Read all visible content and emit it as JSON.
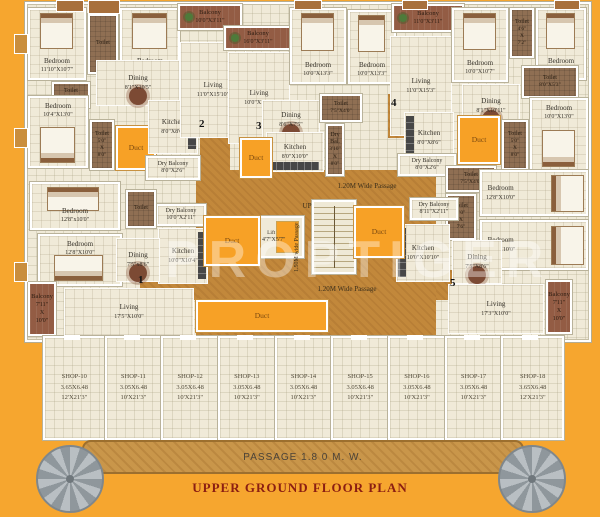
{
  "footer": {
    "passage": "PASSAGE 1.8 0 M. W.",
    "title": "UPPER GROUND FLOOR PLAN",
    "watermark": "PROPTIGER"
  },
  "colors": {
    "background_orange": "#F6A62F",
    "room_cream": "#F0EAD8",
    "passage_tan": "#C2883B",
    "duct_orange": "#F7A126",
    "toilet_brown": "#8F6F53",
    "balcony_brown": "#935C44",
    "wall_white": "#FFFFFF",
    "title_maroon": "#8B1E12"
  },
  "rooms": [
    {
      "id": "bedroom-nw-1",
      "label": "Bedroom",
      "dims": "11'10\"X10'7\"",
      "type": "room",
      "furn": "bed-t",
      "x": 28,
      "y": 8,
      "w": 58,
      "h": 72
    },
    {
      "id": "toilet-nw-1",
      "label": "Toilet",
      "dims": "",
      "type": "toilet",
      "furn": "",
      "x": 88,
      "y": 14,
      "w": 30,
      "h": 60
    },
    {
      "id": "bedroom-nw-2",
      "label": "Bedroom",
      "dims": "10'0\"X10'7\"",
      "type": "room",
      "furn": "bed-t",
      "x": 120,
      "y": 8,
      "w": 60,
      "h": 72
    },
    {
      "id": "toilet-nw-2",
      "label": "Toilet",
      "dims": "4'0\"X5'0\"",
      "type": "toilet",
      "furn": "",
      "x": 52,
      "y": 82,
      "w": 38,
      "h": 26
    },
    {
      "id": "dining-nw",
      "label": "Dining",
      "dims": "8'1\"X10'5\"",
      "type": "open",
      "furn": "table",
      "x": 96,
      "y": 60,
      "w": 84,
      "h": 46
    },
    {
      "id": "bedroom-nw-3",
      "label": "Bedroom",
      "dims": "10'4\"X13'0\"",
      "type": "room",
      "furn": "bed-b",
      "x": 28,
      "y": 96,
      "w": 60,
      "h": 72
    },
    {
      "id": "toilet-nw-3",
      "label": "Toilet",
      "dims": "5'0\"X8'0\"",
      "type": "toilet-v",
      "furn": "",
      "x": 90,
      "y": 120,
      "w": 24,
      "h": 50
    },
    {
      "id": "duct-nw",
      "label": "Duct",
      "dims": "",
      "type": "duct",
      "furn": "",
      "x": 116,
      "y": 126,
      "w": 40,
      "h": 44
    },
    {
      "id": "kitchen-nw",
      "label": "Kitchen",
      "dims": "8'0\"X8'6\"",
      "type": "open",
      "furn": "counter-r",
      "x": 148,
      "y": 100,
      "w": 50,
      "h": 54
    },
    {
      "id": "drybalcony-nw",
      "label": "Dry Balcony",
      "dims": "8'0\"X2'6\"",
      "type": "dry",
      "furn": "",
      "x": 146,
      "y": 156,
      "w": 54,
      "h": 24
    },
    {
      "id": "living-nw",
      "label": "Living",
      "dims": "11'0\"X15'10\"",
      "type": "open",
      "furn": "",
      "x": 180,
      "y": 42,
      "w": 66,
      "h": 96
    },
    {
      "id": "balcony-top-1",
      "label": "Balcony",
      "dims": "10'0\"X3'11\"",
      "type": "balcony",
      "furn": "",
      "x": 178,
      "y": 4,
      "w": 64,
      "h": 26
    },
    {
      "id": "balcony-top-2",
      "label": "Balcony",
      "dims": "16'0\"X3'11\"",
      "type": "balcony",
      "furn": "",
      "x": 224,
      "y": 26,
      "w": 68,
      "h": 24
    },
    {
      "id": "living-center",
      "label": "Living",
      "dims": "10'0\"X15'5\"",
      "type": "open",
      "furn": "",
      "x": 228,
      "y": 52,
      "w": 62,
      "h": 92
    },
    {
      "id": "bedroom-c-1",
      "label": "Bedroom",
      "dims": "10'0\"X13'3\"",
      "type": "room",
      "furn": "bed-t",
      "x": 290,
      "y": 8,
      "w": 56,
      "h": 76
    },
    {
      "id": "bedroom-c-2",
      "label": "Bedroom",
      "dims": "10'0\"X13'3\"",
      "type": "room",
      "furn": "bed-t",
      "x": 348,
      "y": 10,
      "w": 48,
      "h": 74
    },
    {
      "id": "dining-c",
      "label": "Dining",
      "dims": "8'6\"X7'5\"",
      "type": "open",
      "furn": "table",
      "x": 262,
      "y": 100,
      "w": 58,
      "h": 40
    },
    {
      "id": "toilet-c-1",
      "label": "Toilet",
      "dims": "7'5\"X4'0\"",
      "type": "toilet",
      "furn": "",
      "x": 320,
      "y": 94,
      "w": 42,
      "h": 28
    },
    {
      "id": "kitchen-c",
      "label": "Kitchen",
      "dims": "8'0\"X10'0\"",
      "type": "open",
      "furn": "counter-b",
      "x": 266,
      "y": 132,
      "w": 58,
      "h": 40
    },
    {
      "id": "duct-c",
      "label": "Duct",
      "dims": "",
      "type": "duct",
      "furn": "",
      "x": 240,
      "y": 138,
      "w": 32,
      "h": 40
    },
    {
      "id": "drybal-c",
      "label": "Dry Bal.",
      "dims": "3'10\"X8'0\"",
      "type": "toilet-v",
      "furn": "",
      "x": 326,
      "y": 124,
      "w": 18,
      "h": 52
    },
    {
      "id": "balcony-ne",
      "label": "Balcony",
      "dims": "11'0\"X3'11\"",
      "type": "balcony",
      "furn": "",
      "x": 392,
      "y": 4,
      "w": 72,
      "h": 28
    },
    {
      "id": "living-ne",
      "label": "Living",
      "dims": "11'0\"X15'3\"",
      "type": "open",
      "furn": "",
      "x": 390,
      "y": 36,
      "w": 62,
      "h": 100
    },
    {
      "id": "bedroom-ne-1",
      "label": "Bedroom",
      "dims": "10'0\"X10'7\"",
      "type": "room",
      "furn": "bed-t",
      "x": 452,
      "y": 8,
      "w": 56,
      "h": 74
    },
    {
      "id": "toilet-ne-1",
      "label": "Toilet",
      "dims": "4'6\"X7'2\"",
      "type": "toilet-v",
      "furn": "",
      "x": 510,
      "y": 8,
      "w": 24,
      "h": 50
    },
    {
      "id": "bedroom-ne-2",
      "label": "Bedroom",
      "dims": "10'0\"X10'7\"",
      "type": "room",
      "furn": "bed-t",
      "x": 536,
      "y": 8,
      "w": 50,
      "h": 72
    },
    {
      "id": "toilet-ne-2",
      "label": "Toilet",
      "dims": "8'0\"X5'3\"",
      "type": "toilet",
      "furn": "",
      "x": 522,
      "y": 66,
      "w": 56,
      "h": 32
    },
    {
      "id": "dining-ne",
      "label": "Dining",
      "dims": "8'1\"X10'11\"",
      "type": "open",
      "furn": "table",
      "x": 462,
      "y": 84,
      "w": 58,
      "h": 44
    },
    {
      "id": "kitchen-ne",
      "label": "Kitchen",
      "dims": "8'0\"X8'6\"",
      "type": "open",
      "furn": "counter-l",
      "x": 404,
      "y": 112,
      "w": 50,
      "h": 52
    },
    {
      "id": "duct-ne",
      "label": "Duct",
      "dims": "",
      "type": "duct",
      "furn": "",
      "x": 458,
      "y": 116,
      "w": 42,
      "h": 48
    },
    {
      "id": "toilet-ne-3",
      "label": "Toilet",
      "dims": "5'0\"X8'0\"",
      "type": "toilet-v",
      "furn": "",
      "x": 502,
      "y": 120,
      "w": 26,
      "h": 50
    },
    {
      "id": "bedroom-ne-3",
      "label": "Bedroom",
      "dims": "10'0\"X13'0\"",
      "type": "room",
      "furn": "bed-b",
      "x": 530,
      "y": 98,
      "w": 58,
      "h": 74
    },
    {
      "id": "drybalcony-ne",
      "label": "Dry Balcony",
      "dims": "8'0\"X2'6\"",
      "type": "dry",
      "furn": "",
      "x": 398,
      "y": 154,
      "w": 58,
      "h": 22
    },
    {
      "id": "toilet-se-1",
      "label": "Toilet",
      "dims": "7'5\"X4'0\"",
      "type": "toilet",
      "furn": "",
      "x": 446,
      "y": 166,
      "w": 50,
      "h": 26
    },
    {
      "id": "toilet-se-2",
      "label": "Toilet",
      "dims": "4'0\"X7'6\"",
      "type": "toilet-v",
      "furn": "",
      "x": 446,
      "y": 194,
      "w": 30,
      "h": 46
    },
    {
      "id": "drybalcony-se",
      "label": "Dry Balcony",
      "dims": "8'11\"X2'11\"",
      "type": "dry",
      "furn": "",
      "x": 410,
      "y": 198,
      "w": 48,
      "h": 22
    },
    {
      "id": "bedroom-se-1",
      "label": "Bedroom",
      "dims": "12'8\"X10'0\"",
      "type": "room",
      "furn": "bed-r",
      "x": 480,
      "y": 170,
      "w": 108,
      "h": 46
    },
    {
      "id": "bedroom-se-2",
      "label": "Bedroom",
      "dims": "12'8\"X10'0\"",
      "type": "room",
      "furn": "bed-r",
      "x": 480,
      "y": 220,
      "w": 108,
      "h": 50
    },
    {
      "id": "kitchen-se",
      "label": "Kitchen",
      "dims": "10'0\"X10'10\"",
      "type": "open",
      "furn": "counter-l",
      "x": 396,
      "y": 224,
      "w": 54,
      "h": 58
    },
    {
      "id": "dining-se",
      "label": "Dining",
      "dims": "7'5\"X8'6\"",
      "type": "open",
      "furn": "table",
      "x": 452,
      "y": 240,
      "w": 50,
      "h": 44
    },
    {
      "id": "living-se",
      "label": "Living",
      "dims": "17'3\"X10'0\"",
      "type": "open",
      "furn": "",
      "x": 448,
      "y": 284,
      "w": 96,
      "h": 50
    },
    {
      "id": "balcony-se",
      "label": "Balcony",
      "dims": "7'11\" X 10'0\"",
      "type": "balcony-v",
      "furn": "",
      "x": 546,
      "y": 280,
      "w": 26,
      "h": 54
    },
    {
      "id": "drybalcony-sw",
      "label": "Dry Balcony",
      "dims": "10'0\"X2'11\"",
      "type": "dry",
      "furn": "",
      "x": 156,
      "y": 204,
      "w": 50,
      "h": 22
    },
    {
      "id": "toilet-sw-1",
      "label": "Toilet",
      "dims": "",
      "type": "toilet",
      "furn": "",
      "x": 126,
      "y": 190,
      "w": 30,
      "h": 38
    },
    {
      "id": "bedroom-sw-1",
      "label": "Bedroom",
      "dims": "12'8\"x10'0\"",
      "type": "room",
      "furn": "bed-t",
      "x": 30,
      "y": 182,
      "w": 90,
      "h": 48
    },
    {
      "id": "bedroom-sw-2",
      "label": "Bedroom",
      "dims": "12'8\"X10'0\"",
      "type": "room",
      "furn": "bed-b",
      "x": 38,
      "y": 234,
      "w": 84,
      "h": 52
    },
    {
      "id": "kitchen-sw",
      "label": "Kitchen",
      "dims": "10'0\"X10'4\"",
      "type": "open",
      "furn": "counter-r",
      "x": 158,
      "y": 228,
      "w": 50,
      "h": 56
    },
    {
      "id": "dining-sw",
      "label": "Dining",
      "dims": "7'5\"x8'6\"",
      "type": "open",
      "furn": "table",
      "x": 116,
      "y": 238,
      "w": 44,
      "h": 44
    },
    {
      "id": "living-sw",
      "label": "Living",
      "dims": "17'5\"X10'0\"",
      "type": "open",
      "furn": "",
      "x": 64,
      "y": 288,
      "w": 130,
      "h": 48
    },
    {
      "id": "balcony-sw",
      "label": "Balcony",
      "dims": "7'11\" X 10'0\"",
      "type": "balcony-v",
      "furn": "",
      "x": 28,
      "y": 282,
      "w": 28,
      "h": 54
    },
    {
      "id": "lift",
      "label": "Lift",
      "dims": "4'7\"X5'7\"",
      "type": "lift",
      "furn": "",
      "x": 258,
      "y": 216,
      "w": 46,
      "h": 42
    },
    {
      "id": "duct-core-right",
      "label": "Duct",
      "dims": "",
      "type": "duct",
      "furn": "",
      "x": 354,
      "y": 206,
      "w": 50,
      "h": 52
    },
    {
      "id": "duct-core-left",
      "label": "Duct",
      "dims": "",
      "type": "duct",
      "furn": "",
      "x": 204,
      "y": 216,
      "w": 56,
      "h": 50
    },
    {
      "id": "duct-core-bottom",
      "label": "Duct",
      "dims": "",
      "type": "duct",
      "furn": "",
      "x": 196,
      "y": 300,
      "w": 132,
      "h": 32
    }
  ],
  "passage_labels": [
    {
      "text": "1.20M Wide Passage",
      "x": 306,
      "y": 183,
      "w": 122,
      "h": 12,
      "rot": false
    },
    {
      "text": "1.20M Wide Passage",
      "x": 288,
      "y": 286,
      "w": 118,
      "h": 12,
      "rot": false
    },
    {
      "text": "UP",
      "x": 296,
      "y": 203,
      "w": 22,
      "h": 10,
      "rot": false
    },
    {
      "text": "1.50M wide Passage",
      "x": 294,
      "y": 210,
      "w": 12,
      "h": 74,
      "rot": true
    }
  ],
  "markers": [
    {
      "n": "1",
      "x": 138,
      "y": 274
    },
    {
      "n": "2",
      "x": 199,
      "y": 118
    },
    {
      "n": "3",
      "x": 256,
      "y": 120
    },
    {
      "n": "4",
      "x": 391,
      "y": 97
    },
    {
      "n": "5",
      "x": 450,
      "y": 277
    }
  ],
  "shops": [
    {
      "label": "SHOP-10",
      "metric": "3.65X6.48",
      "imperial": "12'X21'3\""
    },
    {
      "label": "SHOP-11",
      "metric": "3.05X6.48",
      "imperial": "10'X21'3\""
    },
    {
      "label": "SHOP-12",
      "metric": "3.05X6.48",
      "imperial": "10'X21'3\""
    },
    {
      "label": "SHOP-13",
      "metric": "3.05X6.48",
      "imperial": "10'X21'3\""
    },
    {
      "label": "SHOP-14",
      "metric": "3.05X6.48",
      "imperial": "10'X21'3\""
    },
    {
      "label": "SHOP-15",
      "metric": "3.05X6.48",
      "imperial": "10'X21'3\""
    },
    {
      "label": "SHOP-16",
      "metric": "3.05X6.48",
      "imperial": "10'X21'3\""
    },
    {
      "label": "SHOP-17",
      "metric": "3.05X6.48",
      "imperial": "10'X21'3\""
    },
    {
      "label": "SHOP-18",
      "metric": "3.65X6.48",
      "imperial": "12'X21'3\""
    }
  ]
}
